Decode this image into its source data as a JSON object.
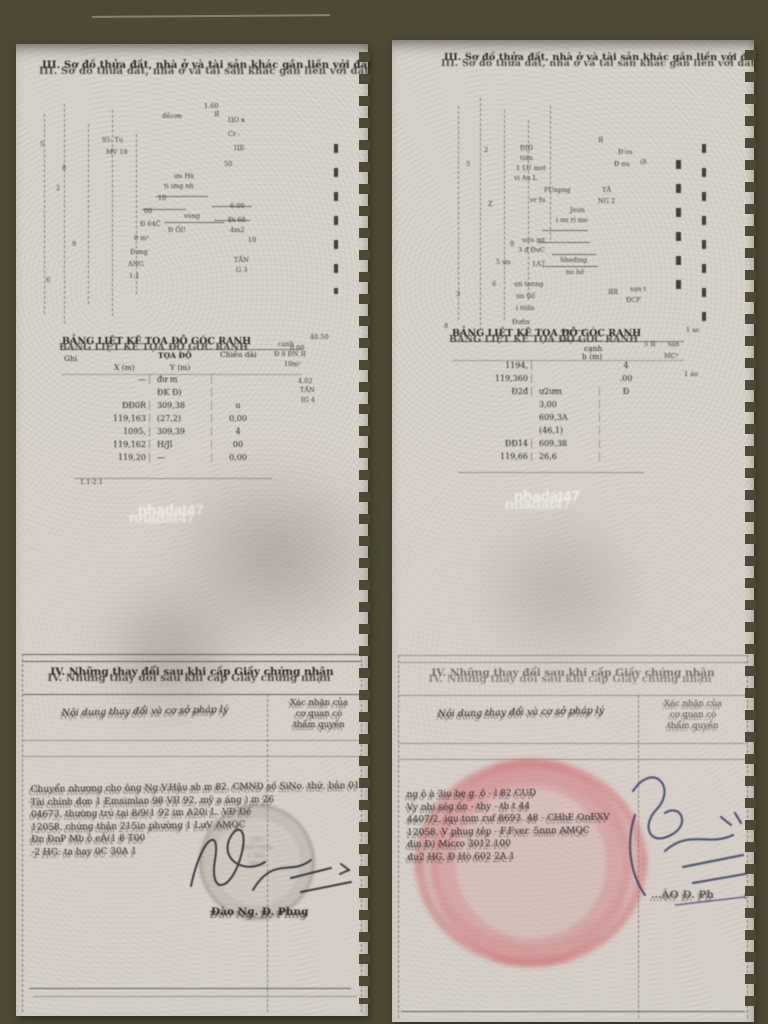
{
  "colors": {
    "photo-bg": "#4d4934",
    "page-bg": "#d9d5cd",
    "ink": "#2a2722",
    "stamp-red": "#c8474f",
    "signature-ink": "#23252e",
    "signature-blue": "#333a5e",
    "watermark": "#f5f3ee"
  },
  "left_page": {
    "header_title": "III. Sơ đồ thửa đất, nhà ở và tài sản khác gắn liền với đất",
    "watermark": "nhadat47",
    "plan": {
      "annotations": [
        {
          "text": "1.60",
          "x": 188,
          "y": 58
        },
        {
          "text": "đềcơn",
          "x": 146,
          "y": 68
        },
        {
          "text": "Я",
          "x": 198,
          "y": 66
        },
        {
          "text": "ЦО в",
          "x": 212,
          "y": 72
        },
        {
          "text": "95: Tu",
          "x": 86,
          "y": 92
        },
        {
          "text": "Cr -",
          "x": 212,
          "y": 86
        },
        {
          "text": "MV 18",
          "x": 90,
          "y": 104
        },
        {
          "text": "ЦБ",
          "x": 218,
          "y": 100
        },
        {
          "text": "50",
          "x": 208,
          "y": 116
        },
        {
          "text": "ưu Hà",
          "x": 158,
          "y": 128
        },
        {
          "text": "ti ưng nh",
          "x": 148,
          "y": 138
        },
        {
          "text": "10",
          "x": 142,
          "y": 150
        },
        {
          "text": "00",
          "x": 128,
          "y": 163
        },
        {
          "text": "Đ 64Č",
          "x": 124,
          "y": 176
        },
        {
          "text": "vòng",
          "x": 168,
          "y": 168
        },
        {
          "text": "Đ ỐI!",
          "x": 152,
          "y": 182
        },
        {
          "text": "0 m²",
          "x": 118,
          "y": 190
        },
        {
          "text": "6.00",
          "x": 214,
          "y": 158
        },
        {
          "text": "Đi 68",
          "x": 212,
          "y": 172
        },
        {
          "text": "4m2",
          "x": 214,
          "y": 182
        },
        {
          "text": "10",
          "x": 232,
          "y": 192
        },
        {
          "text": "Đưng",
          "x": 114,
          "y": 204
        },
        {
          "text": "ANG",
          "x": 112,
          "y": 216
        },
        {
          "text": "1:1",
          "x": 113,
          "y": 228
        },
        {
          "text": "TẦN",
          "x": 218,
          "y": 212
        },
        {
          "text": "G 3",
          "x": 220,
          "y": 222
        },
        {
          "text": "8",
          "x": 46,
          "y": 120
        },
        {
          "text": "5",
          "x": 24,
          "y": 96
        },
        {
          "text": "2",
          "x": 40,
          "y": 140
        },
        {
          "text": "9",
          "x": 56,
          "y": 196
        },
        {
          "text": "6",
          "x": 30,
          "y": 232
        },
        {
          "text": "cạnh",
          "x": 262,
          "y": 296
        },
        {
          "text": "40.50",
          "x": 294,
          "y": 289
        },
        {
          "text": "Đ 8 ĐN Я",
          "x": 258,
          "y": 306
        },
        {
          "text": "10m²",
          "x": 268,
          "y": 316
        },
        {
          "text": "4.02",
          "x": 282,
          "y": 333
        },
        {
          "text": "TẦN",
          "x": 284,
          "y": 342
        },
        {
          "text": "IG 4",
          "x": 285,
          "y": 352
        },
        {
          "text": "0.00",
          "x": 274,
          "y": 300
        },
        {
          "text": "1.1-2.1",
          "x": 64,
          "y": 434
        }
      ]
    },
    "coord_table": {
      "title": "BẢNG LIỆT KÊ TỌA ĐỘ GÓC RANH",
      "headers": {
        "left": "Ghi",
        "group": "TỌA ĐỘ",
        "x": "X (m)",
        "y": "Y (m)",
        "len": "Chiều dài"
      },
      "rows": [
        {
          "x": "—",
          "y": "đư m",
          "len": ""
        },
        {
          "x": "",
          "y": "ĐK Đ)",
          "len": ""
        },
        {
          "x": "ĐĐ0R",
          "y": "309,38",
          "len": "u"
        },
        {
          "x": "119,163",
          "y": "(27,2)",
          "len": "0,00"
        },
        {
          "x": "1095,",
          "y": "309,39",
          "len": "4"
        },
        {
          "x": "119,162",
          "y": "H/Jl",
          "len": "00"
        },
        {
          "x": "119,20",
          "y": "—",
          "len": "0,00"
        }
      ]
    },
    "section4": {
      "title": "IV. Những thay đổi sau khi cấp Giấy chứng nhận",
      "col_left_header": "Nội dung thay đổi và cơ sở pháp lý",
      "col_right_header": [
        "Xác nhận của",
        "cơ quan có",
        "thẩm quyền"
      ],
      "body_lines": [
        "Chuyển nhượng cho ông Ng.V.Hậu sh m 82, CMND số SiNo. thứ, bản 01",
        "Tài chính đơn 1 Emsimlan 98 VII 92, mỹ a áng ) m 26",
        "04673, thường trú tại 8/9(1 92 im A20i L. VĐ Đế",
        "12058, chứng thận 215in phường 1 LưV AMQC",
        "Đn ĐnP Mb ô eÂ(1 8 T00",
        "-2 HG: ta hay 0C 30A 1"
      ],
      "stamp_lines": [
        "J bIG",
        "AAM NiĐ]a",
        "o: KIIL",
        "MX gi"
      ],
      "signer": "Đào Ng. D. Phng"
    }
  },
  "right_page": {
    "header_title": "III. Sơ đồ thửa đất, nhà ở và tài sản khác gắn liền với đất",
    "watermark": "nhadat47",
    "plan": {
      "annotations": [
        {
          "text": "ĐỊD",
          "x": 128,
          "y": 104
        },
        {
          "text": "tiăn",
          "x": 128,
          "y": 114
        },
        {
          "text": "1 LU mst",
          "x": 124,
          "y": 124
        },
        {
          "text": "vi Au L",
          "x": 122,
          "y": 134
        },
        {
          "text": "PUnpng",
          "x": 152,
          "y": 146
        },
        {
          "text": "vr fu",
          "x": 138,
          "y": 156
        },
        {
          "text": "Jeun",
          "x": 178,
          "y": 166
        },
        {
          "text": "i ưu ri me",
          "x": 164,
          "y": 176
        },
        {
          "text": "uou mt",
          "x": 130,
          "y": 196
        },
        {
          "text": "3 đ ĐưC",
          "x": 126,
          "y": 206
        },
        {
          "text": "1A7",
          "x": 140,
          "y": 220
        },
        {
          "text": "Sheding",
          "x": 168,
          "y": 216
        },
        {
          "text": "no hề",
          "x": 174,
          "y": 228
        },
        {
          "text": "5 ưu",
          "x": 104,
          "y": 218
        },
        {
          "text": "un tanng",
          "x": 122,
          "y": 240
        },
        {
          "text": "un tiế",
          "x": 124,
          "y": 252
        },
        {
          "text": "i tiišn",
          "x": 124,
          "y": 264
        },
        {
          "text": "Đưñn",
          "x": 120,
          "y": 278
        },
        {
          "text": "Я",
          "x": 206,
          "y": 96
        },
        {
          "text": "Đ'os",
          "x": 226,
          "y": 108
        },
        {
          "text": "Đ nu",
          "x": 222,
          "y": 120
        },
        {
          "text": "(8",
          "x": 248,
          "y": 118
        },
        {
          "text": "TẦ",
          "x": 210,
          "y": 146
        },
        {
          "text": "NG 2",
          "x": 206,
          "y": 157
        },
        {
          "text": "ЯR",
          "x": 216,
          "y": 248
        },
        {
          "text": "sạn t",
          "x": 238,
          "y": 245
        },
        {
          "text": "ĐCF",
          "x": 234,
          "y": 256
        },
        {
          "text": "5",
          "x": 74,
          "y": 120
        },
        {
          "text": "2",
          "x": 92,
          "y": 106
        },
        {
          "text": "Z",
          "x": 96,
          "y": 160
        },
        {
          "text": "9",
          "x": 118,
          "y": 200
        },
        {
          "text": "3",
          "x": 64,
          "y": 250
        },
        {
          "text": "6",
          "x": 100,
          "y": 240
        },
        {
          "text": "8",
          "x": 52,
          "y": 282
        },
        {
          "text": "1 ac",
          "x": 294,
          "y": 286
        },
        {
          "text": "5 Я",
          "x": 252,
          "y": 300
        },
        {
          "text": "sạn",
          "x": 276,
          "y": 300
        },
        {
          "text": "MC³",
          "x": 272,
          "y": 312
        },
        {
          "text": "1 áo",
          "x": 292,
          "y": 330
        }
      ]
    },
    "coord_table": {
      "title": "BẢNG LIỆT KÊ TỌA ĐỘ GÓC RANH",
      "headers": {
        "len": "cạnh",
        "h": "h (m)"
      },
      "rows": [
        {
          "a": "1194,",
          "b": "",
          "c": "4"
        },
        {
          "a": "119,360",
          "b": "",
          "c": ".00"
        },
        {
          "a": "Đ2đ",
          "b": "ư2ưm",
          "c": "Đ"
        },
        {
          "a": "",
          "b": "3,00",
          "c": ""
        },
        {
          "a": "",
          "b": "609,3A",
          "c": ""
        },
        {
          "a": "",
          "b": "(46,1)",
          "c": ""
        },
        {
          "a": "ĐĐ14",
          "b": "609,38",
          "c": ""
        },
        {
          "a": "119,66",
          "b": "26,6",
          "c": ""
        }
      ]
    },
    "section4": {
      "title": "IV. Những thay đổi sau khi cấp Giấy chứng nhận",
      "col_left_header": "Nội dung thay đổi và cơ sở pháp lý",
      "col_right_header": [
        "Xác nhận của",
        "cơ quan có",
        "thẩm quyền"
      ],
      "body_lines": [
        "ng ô à 3iu bę g. ô - l 82 CUD",
        "Vy nhi ség ôn - thy - th t 44",
        "4407/2, iqu tom ruf 8693. 48 - CHhE OnEXV",
        "12058, V phug têp - F.Fver. 5nnn AMQC",
        "đin Đ) Micro 3012.100",
        "đu2 HG, Đ Hò 602 2A.1"
      ],
      "signer_partial": "…ÀO D. Ph"
    }
  }
}
